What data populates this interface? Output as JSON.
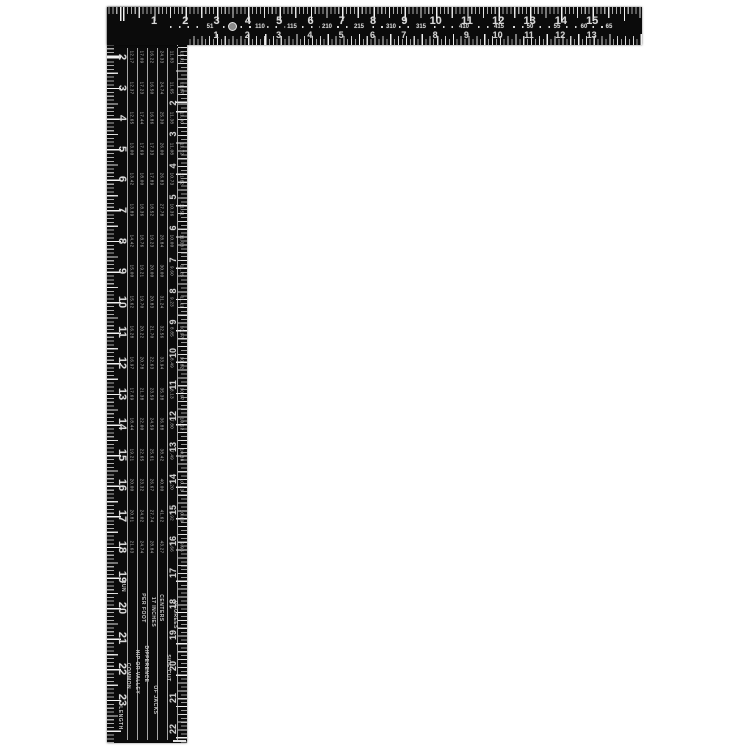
{
  "product": {
    "description": "Black steel L-shaped framing square with white etched scales on a white background"
  },
  "colors": {
    "body": "#0b0b0b",
    "markings": "#d9d9d9",
    "background": "#ffffff"
  },
  "horizontal_arm": {
    "outer_scale_numbers": [
      "1",
      "2",
      "3",
      "4",
      "5",
      "6",
      "7",
      "8",
      "9",
      "10",
      "11",
      "12",
      "13",
      "14",
      "15"
    ],
    "middle_band_numbers": [
      "51",
      "110",
      "115",
      "210",
      "215",
      "310",
      "315",
      "410",
      "415",
      "50",
      "55",
      "60",
      "65"
    ],
    "inner_scale_numbers": [
      "1",
      "2",
      "3",
      "4",
      "5",
      "6",
      "7",
      "8",
      "9",
      "10",
      "11",
      "12",
      "13"
    ],
    "hang_hole_icon": "circle-hole"
  },
  "vertical_arm": {
    "outer_scale_numbers": [
      "2",
      "3",
      "4",
      "5",
      "6",
      "7",
      "8",
      "9",
      "10",
      "11",
      "12",
      "13",
      "14",
      "15",
      "16",
      "17",
      "18",
      "19",
      "20",
      "21",
      "22",
      "23"
    ],
    "inner_scale_numbers": [
      "2",
      "3",
      "4",
      "5",
      "6",
      "7",
      "8",
      "9",
      "10",
      "11",
      "12",
      "13",
      "14",
      "15",
      "16",
      "17",
      "18",
      "19",
      "20",
      "21",
      "22"
    ],
    "rafter_table": {
      "pitches": [
        "2",
        "3",
        "4",
        "5",
        "6",
        "7",
        "8",
        "9",
        "10",
        "11",
        "12",
        "13",
        "14",
        "15",
        "16",
        "17",
        "18"
      ],
      "rows": [
        [
          "12.17",
          "17.09",
          "16.22",
          "24.33",
          "11.83",
          "11.91"
        ],
        [
          "12.37",
          "17.23",
          "16.50",
          "24.74",
          "11.65",
          "11.87"
        ],
        [
          "12.65",
          "17.44",
          "16.86",
          "25.30",
          "11.38",
          "11.80"
        ],
        [
          "13.00",
          "17.69",
          "17.33",
          "26.00",
          "11.08",
          "11.72"
        ],
        [
          "13.42",
          "18.00",
          "17.89",
          "26.83",
          "10.73",
          "11.62"
        ],
        [
          "13.89",
          "18.36",
          "18.52",
          "27.78",
          "10.36",
          "11.51"
        ],
        [
          "14.42",
          "18.76",
          "19.23",
          "28.84",
          "10.00",
          "11.38"
        ],
        [
          "15.00",
          "19.21",
          "20.00",
          "30.00",
          "9.60",
          "11.25"
        ],
        [
          "15.62",
          "19.70",
          "20.83",
          "31.24",
          "9.23",
          "11.11"
        ],
        [
          "16.28",
          "20.22",
          "21.70",
          "32.56",
          "8.85",
          "10.97"
        ],
        [
          "16.97",
          "20.78",
          "22.63",
          "33.94",
          "8.49",
          "10.82"
        ],
        [
          "17.69",
          "21.38",
          "23.59",
          "35.38",
          "8.13",
          "10.67"
        ],
        [
          "18.44",
          "22.00",
          "24.59",
          "36.88",
          "7.80",
          "10.52"
        ],
        [
          "19.21",
          "22.65",
          "25.61",
          "38.42",
          "7.49",
          "10.38"
        ],
        [
          "20.00",
          "23.32",
          "26.67",
          "40.00",
          "7.20",
          "10.23"
        ],
        [
          "20.81",
          "24.02",
          "27.74",
          "41.62",
          "6.92",
          "10.09"
        ],
        [
          "21.63",
          "24.74",
          "28.84",
          "43.27",
          "6.66",
          "9.96"
        ]
      ],
      "headings": [
        "RUN",
        "LENGTH",
        "COMMON",
        "PER FOOT",
        "HIP OR VALLEY",
        "DIFFERENCE",
        "17 INCHES",
        "CENTERS",
        "OF JACKS",
        "SIDE CUT",
        "DEGREES"
      ]
    }
  }
}
